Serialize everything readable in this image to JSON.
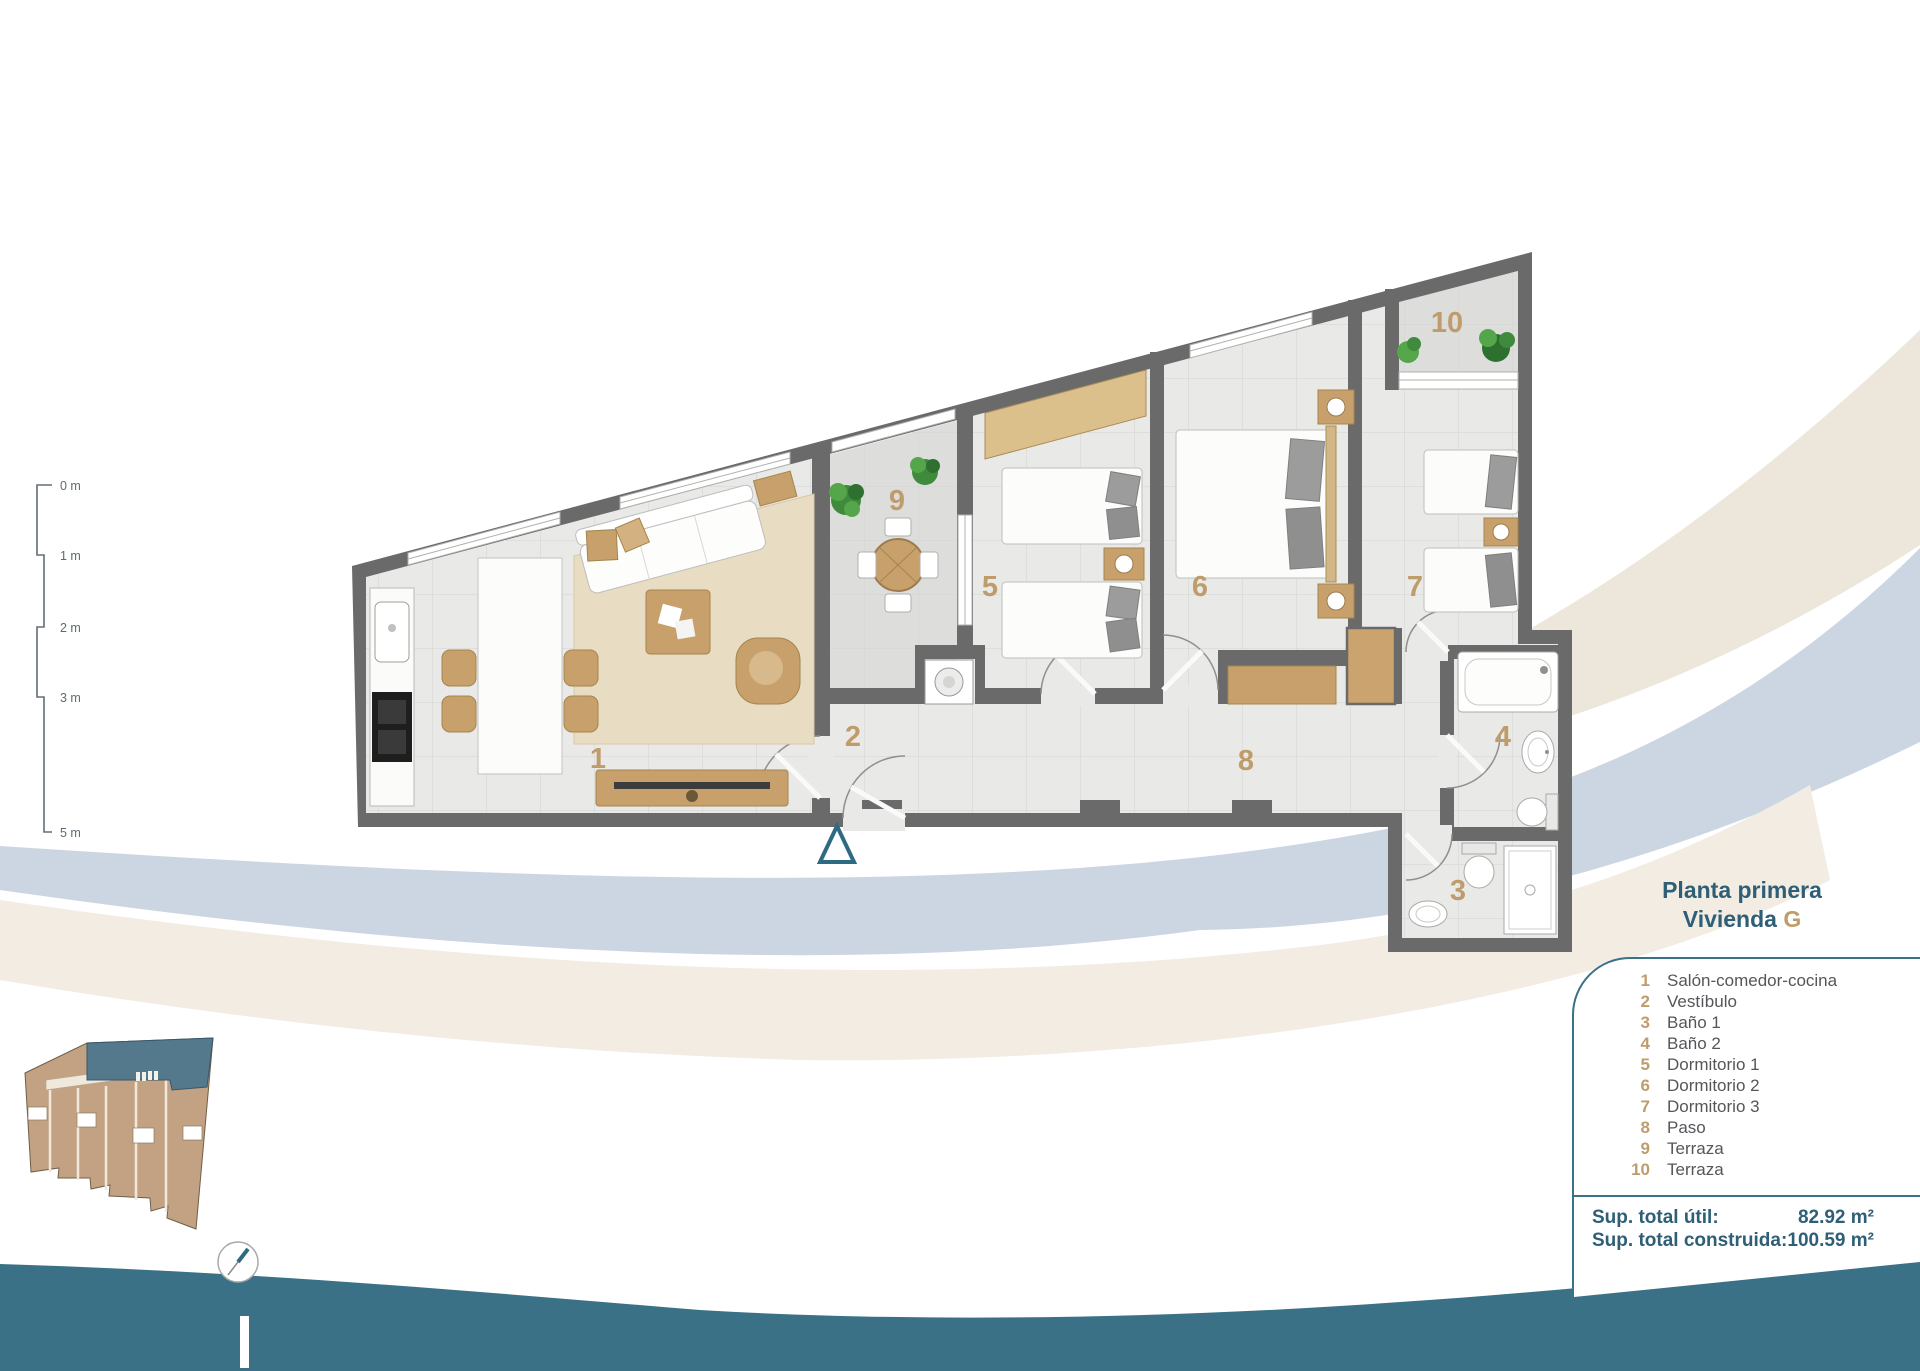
{
  "title": {
    "line1": "Planta primera",
    "line2_prefix": "Vivienda ",
    "line2_unit": "G"
  },
  "legend": {
    "items": [
      {
        "num": "1",
        "label": "Salón-comedor-cocina"
      },
      {
        "num": "2",
        "label": "Vestíbulo"
      },
      {
        "num": "3",
        "label": "Baño 1"
      },
      {
        "num": "4",
        "label": "Baño 2"
      },
      {
        "num": "5",
        "label": "Dormitorio 1"
      },
      {
        "num": "6",
        "label": "Dormitorio 2"
      },
      {
        "num": "7",
        "label": "Dormitorio 3"
      },
      {
        "num": "8",
        "label": "Paso"
      },
      {
        "num": "9",
        "label": "Terraza"
      },
      {
        "num": "10",
        "label": "Terraza"
      }
    ]
  },
  "totals": {
    "rows": [
      {
        "label": "Sup. total útil:",
        "value": "82.92 m²"
      },
      {
        "label": "Sup. total construida:",
        "value": "100.59 m²"
      }
    ]
  },
  "scalebar": {
    "labels": [
      "0 m",
      "1 m",
      "2 m",
      "3 m",
      "5 m"
    ]
  },
  "plan": {
    "room_numbers": [
      "1",
      "2",
      "3",
      "4",
      "5",
      "6",
      "7",
      "8",
      "9",
      "10"
    ]
  },
  "colors": {
    "title_teal": "#2e5f76",
    "panel_border_teal": "#3a7187",
    "bottom_band_teal": "#3a7187",
    "room_number_tan": "#bf9c6c",
    "wall_gray": "#6a6a6a",
    "floor_gray": "#e9e9e7",
    "terrace_gray": "#dddddb",
    "furniture_tan": "#c7a06b",
    "swirl_blue": "#ccd6e3",
    "swirl_cream": "#ede6db",
    "minimap_tan": "#c2a283",
    "minimap_highlight_teal": "#54798d"
  }
}
